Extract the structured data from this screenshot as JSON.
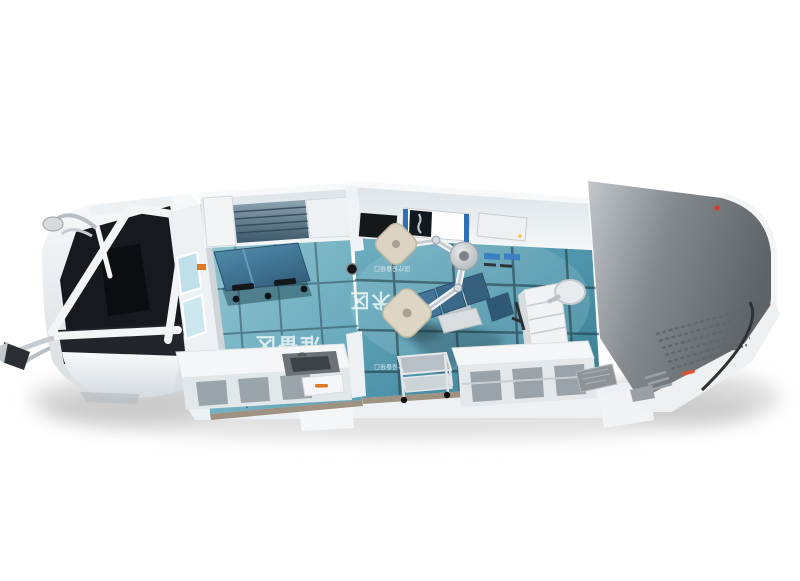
{
  "scene": {
    "subject": "Cutaway 3D render of a mobile clinic / surgery vehicle seen from above at an angle",
    "background": "#ffffff"
  },
  "palette": {
    "body_white": "#f2f4f6",
    "wall_shade": "#d9dee2",
    "floor_prep_teal": "#7ab8c8",
    "floor_surgery_teal": "#4d93a9",
    "floor_grid": "#1e3a46",
    "equipment_blue": "#3d6e8e",
    "lamp_cream": "#dcd4c2",
    "cab_glass_dark": "#16191d",
    "rear_roof_gray": "#6a6f74",
    "cabinet_glass_green": "#4d685a",
    "accent_red": "#d23c2a",
    "accent_orange": "#e07820",
    "screen_green": "#37a24c"
  },
  "zones": {
    "preparation": {
      "label": "准备区"
    },
    "surgery": {
      "label": "手术区"
    }
  },
  "floor_markers": {
    "marker1": {
      "text": "医疗设备接口"
    },
    "marker2": {
      "text": "医疗设备接口"
    }
  }
}
